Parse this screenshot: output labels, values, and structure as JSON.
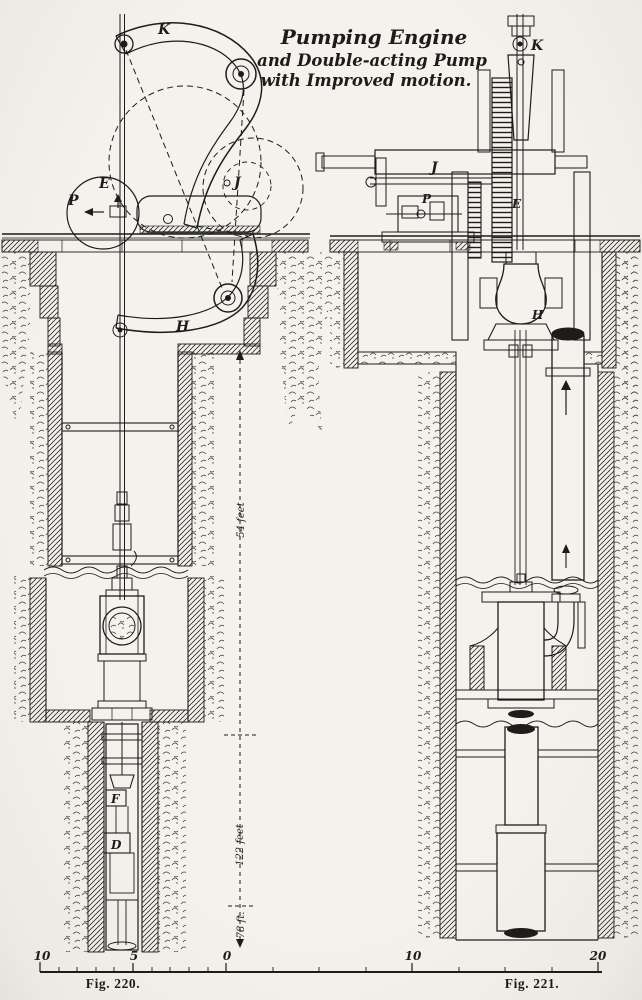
{
  "palette": {
    "paper": "#f2f0ea",
    "ink": "#1d1c1a"
  },
  "title": {
    "line1": "Pumping Engine",
    "line2": "and Double-acting Pump",
    "line3": "with Improved motion."
  },
  "fig220": {
    "caption": "Fig. 220.",
    "labels": {
      "k": "K",
      "e": "E",
      "p": "P",
      "j": "J",
      "h": "H",
      "f": "F",
      "d": "D"
    },
    "dimensions": {
      "upper": "54 feet",
      "lower": "122 feet",
      "bottom": "78 ft."
    }
  },
  "fig221": {
    "caption": "Fig. 221.",
    "labels": {
      "k": "K",
      "j": "J",
      "p": "P",
      "e": "E",
      "h": "H"
    }
  },
  "scale": {
    "ticks": [
      "10",
      "5",
      "0",
      "10",
      "20"
    ]
  }
}
